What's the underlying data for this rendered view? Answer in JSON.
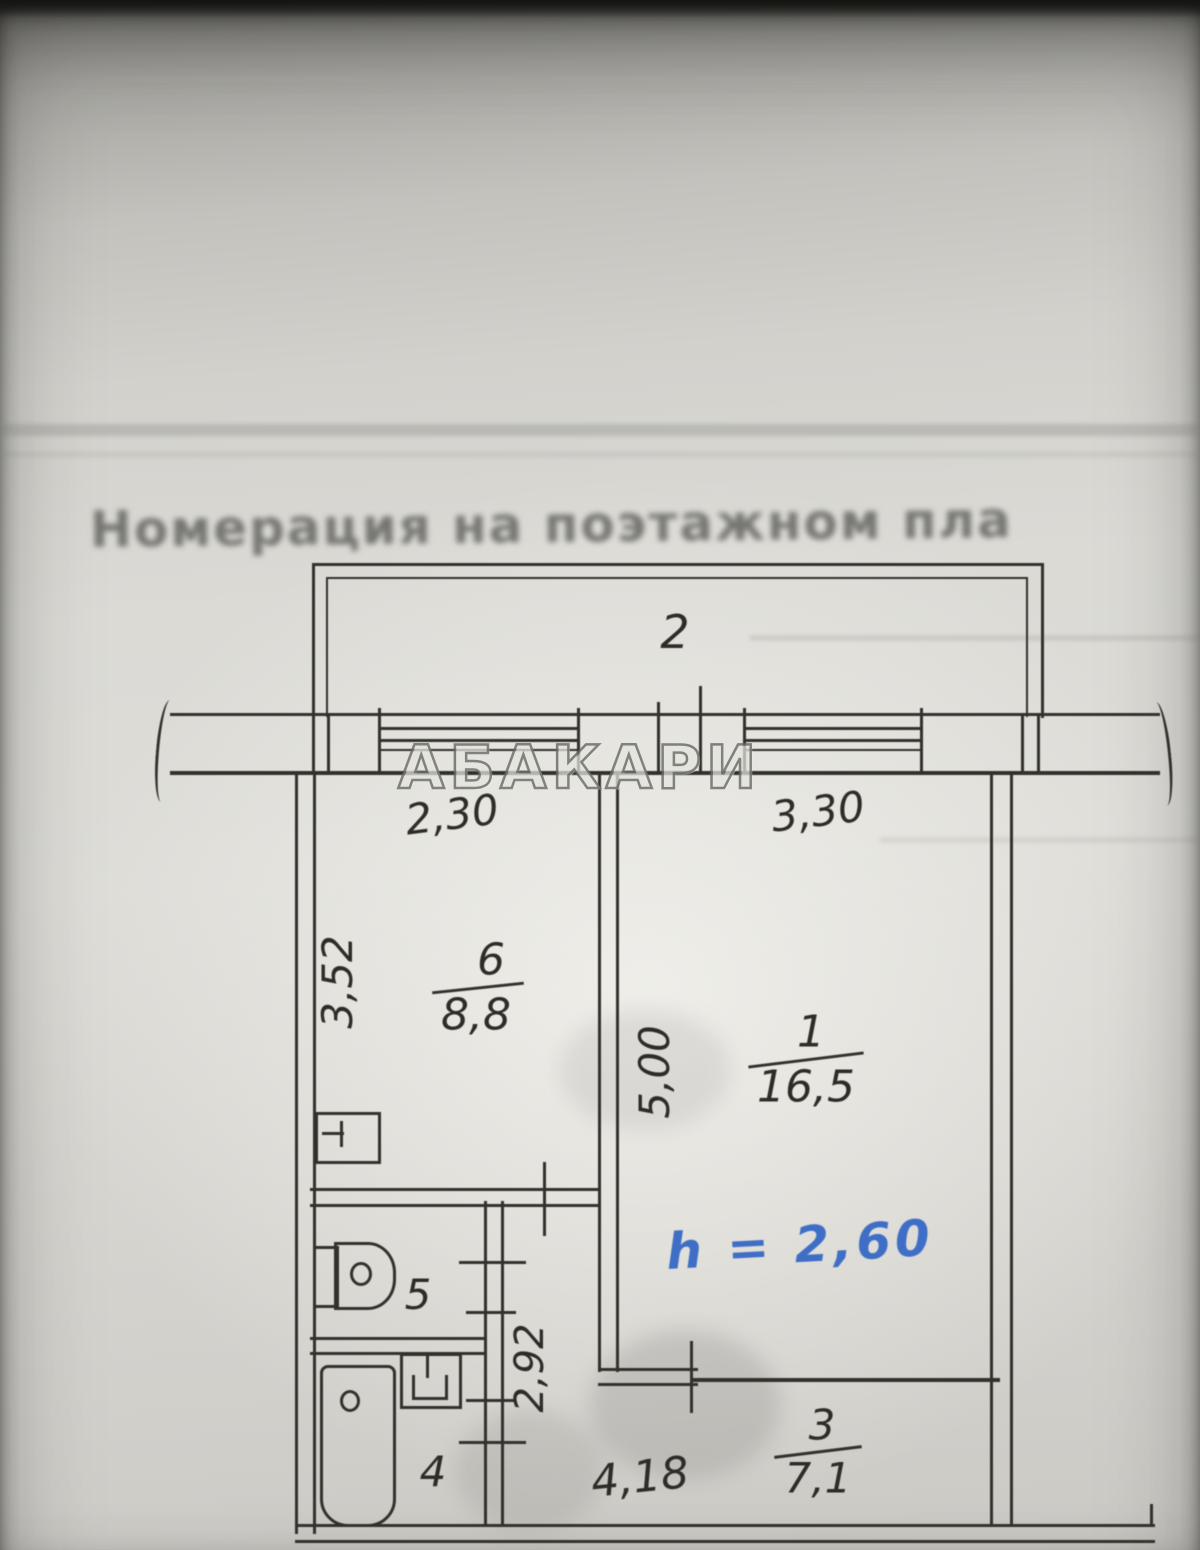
{
  "photo": {
    "faded_header": "Номерация на поэтажном пла",
    "watermark": "АБАКАРИ"
  },
  "plan": {
    "balcony_label": "2",
    "rooms": {
      "kitchen": {
        "number": "6",
        "area": "8,8"
      },
      "living": {
        "number": "1",
        "area": "16,5"
      },
      "toilet": {
        "number": "5"
      },
      "bath": {
        "number": "4"
      },
      "hall": {
        "number": "3",
        "area": "7,1"
      }
    },
    "dimensions": {
      "window_left": "2,30",
      "window_right": "3,30",
      "kitchen_depth": "3,52",
      "living_depth": "5,00",
      "corridor_depth": "2,92",
      "bottom_width": "4,18"
    },
    "ceiling_height": "h = 2,60"
  }
}
